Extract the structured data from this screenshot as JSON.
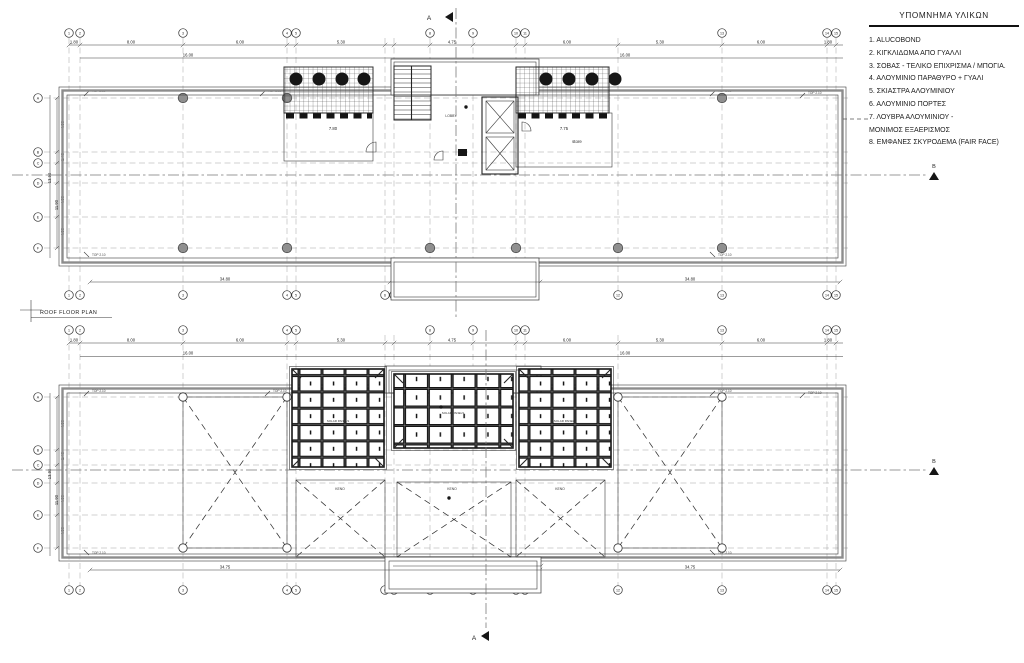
{
  "legend": {
    "title": "ΥΠΟΜΝΗΜΑ ΥΛΙΚΩΝ",
    "items": [
      "1. ALUCOBOND",
      "2. ΚΙΓΚΛΙΔΩΜΑ ΑΠΟ ΓΥΑΛΛΙ",
      "3. ΣΟΒΑΣ - ΤΕΛΙΚΟ ΕΠΙΧΡΙΣΜΑ / ΜΠΟΓΙΑ.",
      "4. ΑΛΟΥΜΙΝΙΟ ΠΑΡΑΘΥΡΟ + ΓΥΑΛΙ",
      "5. ΣΚΙΑΣΤΡΑ ΑΛΟΥΜΙΝΙΟΥ",
      "6. ΑΛΟΥΜΙΝΙΟ ΠΟΡΤΕΣ",
      "7. ΛΟΥΒΡΑ ΑΛΟΥΜΙΝΙΟΥ -\n    ΜΟΝΙΜΟΣ ΕΞΑΕΡΙΣΜΟΣ",
      "8. ΕΜΦΑΝΕΣ ΣΚΥΡΟΔΕΜΑ (FAIR FACE)"
    ]
  },
  "labels": {
    "plan_label": "ROOF FLOOR PLAN",
    "store": "store",
    "lobby": "LOBBY",
    "void": "ΚΕΝΟ",
    "solar_panels": "SOLAR PANELS",
    "top_note": "TOP 2.10",
    "section_a": "A",
    "section_b": "B"
  },
  "drawing": {
    "columns": [
      {
        "x": 69,
        "l": "1",
        "t": 1
      },
      {
        "x": 80,
        "l": "2",
        "t": 1
      },
      {
        "x": 183,
        "l": "3",
        "t": 1
      },
      {
        "x": 287,
        "l": "4",
        "t": 1
      },
      {
        "x": 296,
        "l": "5",
        "t": 1
      },
      {
        "x": 385,
        "l": "6"
      },
      {
        "x": 394,
        "l": "7"
      },
      {
        "x": 430,
        "l": "8",
        "t": 1
      },
      {
        "x": 473,
        "l": "9",
        "t": 1
      },
      {
        "x": 516,
        "l": "10",
        "t": 1
      },
      {
        "x": 525,
        "l": "11",
        "t": 1
      },
      {
        "x": 618,
        "l": "12"
      },
      {
        "x": 722,
        "l": "13",
        "t": 1
      },
      {
        "x": 827,
        "l": "14",
        "t": 1
      },
      {
        "x": 836,
        "l": "15",
        "t": 1
      }
    ],
    "plans": [
      {
        "gy1": 38,
        "gy2": 292,
        "tb": 33,
        "bb": 295,
        "ticky": 45,
        "rows": [
          {
            "y": 98,
            "l": "A"
          },
          {
            "y": 152,
            "l": "B"
          },
          {
            "y": 163,
            "l": "C"
          },
          {
            "y": 183,
            "l": "D"
          },
          {
            "y": 217,
            "l": "E"
          },
          {
            "y": 248,
            "l": "F"
          }
        ]
      },
      {
        "gy1": 335,
        "gy2": 586,
        "tb": 330,
        "bb": 590,
        "ticky": 343,
        "rows": [
          {
            "y": 397,
            "l": "A"
          },
          {
            "y": 450,
            "l": "B"
          },
          {
            "y": 465,
            "l": "C"
          },
          {
            "y": 483,
            "l": "D"
          },
          {
            "y": 515,
            "l": "E"
          },
          {
            "y": 548,
            "l": "F"
          }
        ]
      }
    ],
    "dims": [
      {
        "x": 74,
        "y": 43.5,
        "t": "1.80"
      },
      {
        "x": 131,
        "y": 43.5,
        "t": "8.00"
      },
      {
        "x": 240,
        "y": 43.5,
        "t": "6.00"
      },
      {
        "x": 341,
        "y": 43.5,
        "t": "5.30"
      },
      {
        "x": 452,
        "y": 43.5,
        "t": "4.75"
      },
      {
        "x": 567,
        "y": 43.5,
        "t": "6.00"
      },
      {
        "x": 660,
        "y": 43.5,
        "t": "5.30"
      },
      {
        "x": 761,
        "y": 43.5,
        "t": "6.00"
      },
      {
        "x": 828,
        "y": 43.5,
        "t": "1.80"
      },
      {
        "x": 188,
        "y": 56.5,
        "t": "16.00"
      },
      {
        "x": 625,
        "y": 56.5,
        "t": "16.00"
      },
      {
        "x": 225,
        "y": 280.5,
        "t": "34.80"
      },
      {
        "x": 690,
        "y": 280.5,
        "t": "34.80"
      },
      {
        "x": 51,
        "y": 178,
        "t": "13.90",
        "r": 1
      },
      {
        "x": 58,
        "y": 205,
        "t": "11.90",
        "r": 1
      },
      {
        "x": 64,
        "y": 125,
        "t": "4.50",
        "r": 1
      },
      {
        "x": 64,
        "y": 157,
        "t": "1.40",
        "r": 1
      },
      {
        "x": 64,
        "y": 200,
        "t": "4.50",
        "r": 1
      },
      {
        "x": 64,
        "y": 232,
        "t": "4.50",
        "r": 1
      },
      {
        "x": 333,
        "y": 130,
        "t": "7.80"
      },
      {
        "x": 564,
        "y": 130,
        "t": "7.75"
      },
      {
        "x": 74,
        "y": 341.5,
        "t": "1.80"
      },
      {
        "x": 131,
        "y": 341.5,
        "t": "8.00"
      },
      {
        "x": 240,
        "y": 341.5,
        "t": "6.00"
      },
      {
        "x": 341,
        "y": 341.5,
        "t": "5.30"
      },
      {
        "x": 452,
        "y": 341.5,
        "t": "4.75"
      },
      {
        "x": 567,
        "y": 341.5,
        "t": "6.00"
      },
      {
        "x": 660,
        "y": 341.5,
        "t": "5.30"
      },
      {
        "x": 761,
        "y": 341.5,
        "t": "6.00"
      },
      {
        "x": 828,
        "y": 341.5,
        "t": "1.80"
      },
      {
        "x": 188,
        "y": 354.5,
        "t": "16.00"
      },
      {
        "x": 625,
        "y": 354.5,
        "t": "16.00"
      },
      {
        "x": 225,
        "y": 568.5,
        "t": "34.75"
      },
      {
        "x": 690,
        "y": 568.5,
        "t": "34.75"
      },
      {
        "x": 455,
        "y": 564.5,
        "t": "15.00"
      },
      {
        "x": 51,
        "y": 474,
        "t": "13.90",
        "r": 1
      },
      {
        "x": 58,
        "y": 500,
        "t": "11.90",
        "r": 1
      },
      {
        "x": 64,
        "y": 424,
        "t": "4.50",
        "r": 1
      },
      {
        "x": 64,
        "y": 456,
        "t": "1.40",
        "r": 1
      },
      {
        "x": 64,
        "y": 499,
        "t": "4.50",
        "r": 1
      },
      {
        "x": 64,
        "y": 531,
        "t": "4.50",
        "r": 1
      }
    ],
    "notes": [
      {
        "x": 92,
        "y": 92
      },
      {
        "x": 268,
        "y": 92
      },
      {
        "x": 718,
        "y": 92
      },
      {
        "x": 808,
        "y": 94
      },
      {
        "x": 92,
        "y": 256,
        "f": 1
      },
      {
        "x": 718,
        "y": 256,
        "f": 1
      },
      {
        "x": 92,
        "y": 392
      },
      {
        "x": 273,
        "y": 392
      },
      {
        "x": 718,
        "y": 392
      },
      {
        "x": 808,
        "y": 394
      },
      {
        "x": 92,
        "y": 554,
        "f": 1
      },
      {
        "x": 718,
        "y": 554,
        "f": 1
      }
    ],
    "col_circles": [
      {
        "y": 98,
        "xs": [
          183,
          287,
          722
        ]
      },
      {
        "y": 248,
        "xs": [
          183,
          287,
          430,
          516,
          618,
          722
        ]
      }
    ],
    "ticks": [
      {
        "y": 45,
        "cols": 1
      },
      {
        "y": 343,
        "cols": 1
      },
      {
        "y": 282,
        "xs": [
          90,
          390,
          540,
          840
        ]
      },
      {
        "y": 570,
        "xs": [
          90,
          390,
          540,
          840
        ]
      },
      {
        "y": 566,
        "xs": [
          393,
          541
        ]
      }
    ]
  }
}
